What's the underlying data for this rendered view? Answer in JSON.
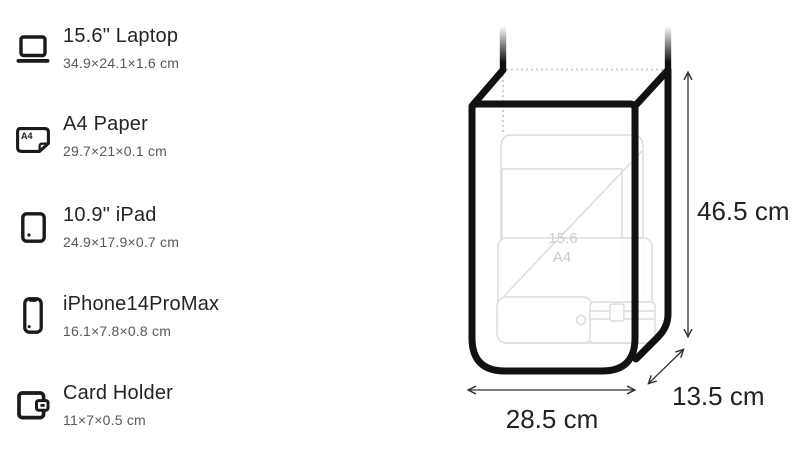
{
  "items": [
    {
      "icon": "laptop-icon",
      "name": "15.6\" Laptop",
      "dims": "34.9×24.1×1.6 cm"
    },
    {
      "icon": "a4-paper-icon",
      "name": "A4 Paper",
      "dims": "29.7×21×0.1 cm"
    },
    {
      "icon": "ipad-icon",
      "name": "10.9\" iPad",
      "dims": "24.9×17.9×0.7 cm"
    },
    {
      "icon": "iphone-icon",
      "name": "iPhone14ProMax",
      "dims": "16.1×7.8×0.8 cm"
    },
    {
      "icon": "card-holder-icon",
      "name": "Card Holder",
      "dims": "11×7×0.5 cm"
    }
  ],
  "diagram": {
    "height_label": "46.5 cm",
    "width_label": "28.5 cm",
    "depth_label": "13.5 cm",
    "content_marks": {
      "laptop": "15.6",
      "paper": "A4"
    }
  },
  "icon_glyphs": {
    "a4_label": "A4"
  },
  "colors": {
    "ink": "#111111",
    "text_primary": "#242424",
    "text_secondary": "#585858",
    "faint_outline": "#dcdcdc",
    "dotted_line": "#c4c4c4",
    "arrow": "#333333"
  }
}
